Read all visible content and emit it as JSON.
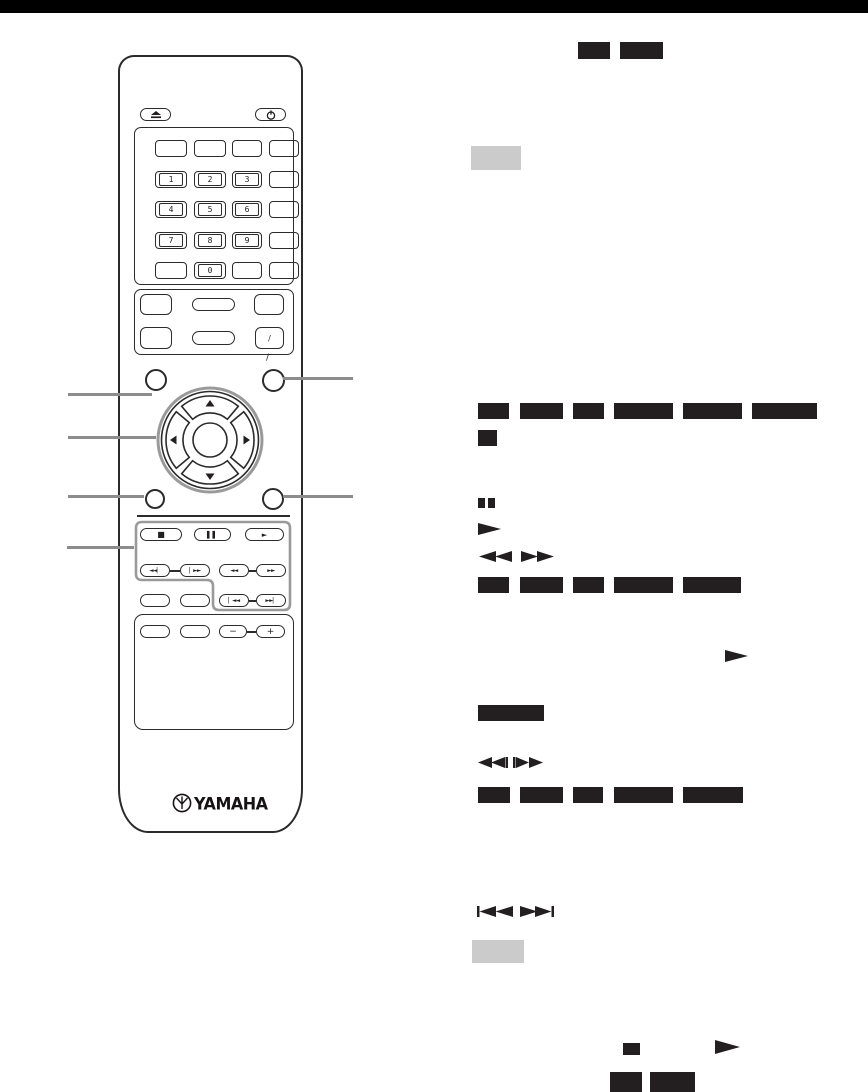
{
  "page": {
    "width": 868,
    "height": 1092,
    "background": "#ffffff"
  },
  "colors": {
    "top_bar": "#000000",
    "media_badge": "#231f20",
    "note_badge": "#cbcbcb",
    "callout_line": "#8c8c8c",
    "line_art": "#2b2b2b",
    "group_outline": "#9a9a9a"
  },
  "remote": {
    "brand": "YAMAHA",
    "key_rows": [
      [
        "",
        "",
        "",
        ""
      ],
      [
        "1",
        "2",
        "3",
        ""
      ],
      [
        "4",
        "5",
        "6",
        ""
      ],
      [
        "7",
        "8",
        "9",
        ""
      ],
      [
        "",
        "0",
        "",
        ""
      ]
    ],
    "slash_key": "/",
    "slash_tick": "/",
    "volume_minus": "−",
    "volume_plus": "+",
    "transport": {
      "stop": "■",
      "pause": "▌▌",
      "play": "►",
      "slow_rev": "◄◄▏",
      "slow_fwd": "▏►►",
      "search_rev": "◄◄",
      "search_fwd": "►►",
      "skip_rev": "▏◄◄",
      "skip_fwd": "►►▏"
    },
    "icons": [
      "eject-icon",
      "power-icon",
      "cursor-pad",
      "yamaha-logo"
    ]
  },
  "right_column": {
    "icons": [
      "pause-icon",
      "play-icon",
      "search-backward-icon",
      "search-forward-icon",
      "play-icon",
      "slow-backward-icon",
      "slow-forward-icon",
      "skip-backward-icon",
      "skip-forward-icon",
      "stop-icon",
      "play-icon"
    ],
    "badges": {
      "top": {
        "y": 42,
        "h": 17,
        "items": [
          [
            578,
            32
          ],
          [
            620,
            43
          ]
        ]
      },
      "row_a": {
        "y": 403,
        "h": 16,
        "items": [
          [
            478,
            31
          ],
          [
            520,
            43
          ],
          [
            573,
            31
          ],
          [
            614,
            59
          ],
          [
            683,
            59
          ],
          [
            752,
            65
          ]
        ]
      },
      "single_a": {
        "y": 430,
        "h": 16,
        "items": [
          [
            478,
            19
          ]
        ]
      },
      "row_b": {
        "y": 577,
        "h": 16,
        "items": [
          [
            478,
            31
          ],
          [
            520,
            43
          ],
          [
            573,
            31
          ],
          [
            614,
            59
          ],
          [
            683,
            58
          ]
        ]
      },
      "long": {
        "y": 705,
        "h": 16,
        "items": [
          [
            478,
            66
          ]
        ]
      },
      "row_c": {
        "y": 787,
        "h": 16,
        "items": [
          [
            478,
            32
          ],
          [
            520,
            43
          ],
          [
            573,
            30
          ],
          [
            614,
            59
          ],
          [
            683,
            60
          ]
        ]
      },
      "bottom": {
        "y": 1072,
        "h": 20,
        "items": [
          [
            610,
            32
          ],
          [
            650,
            45
          ]
        ]
      }
    },
    "note_badges": [
      {
        "x": 471,
        "y": 146,
        "w": 50,
        "h": 24
      },
      {
        "x": 472,
        "y": 940,
        "w": 52,
        "h": 23
      }
    ]
  }
}
